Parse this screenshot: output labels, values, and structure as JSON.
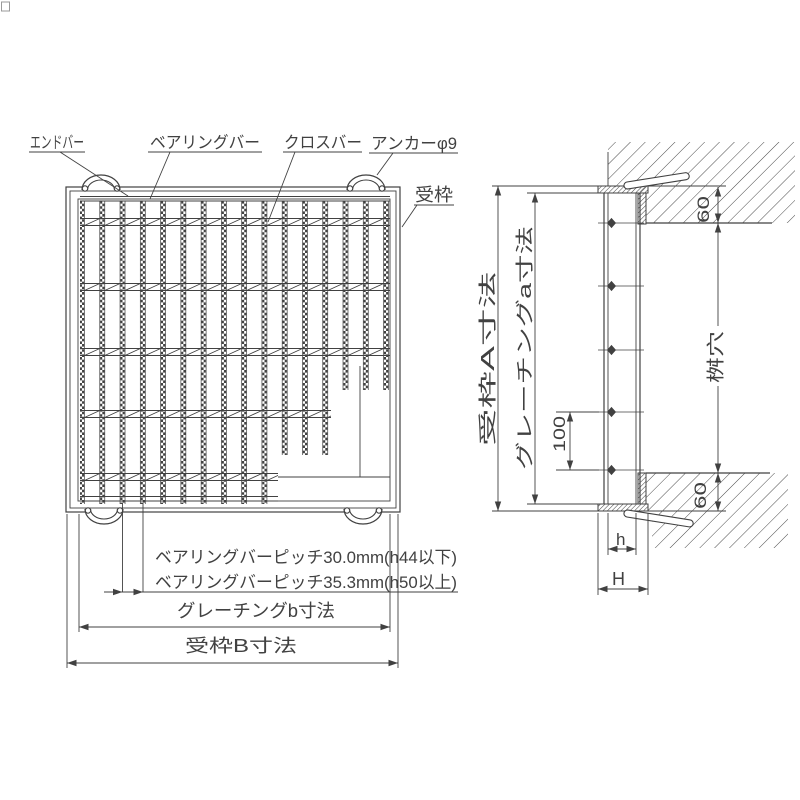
{
  "plan": {
    "labels": {
      "end_bar": "エンドバー",
      "bearing_bar": "ベアリングバー",
      "cross_bar": "クロスバー",
      "anchor": "アンカーφ9",
      "frame": "受枠"
    },
    "notes": {
      "pitch_small": "ベアリングバーピッチ30.0mm(h44以下)",
      "pitch_large": "ベアリングバーピッチ35.3mm(h50以上)"
    },
    "dims": {
      "grating_width": "グレーチングb寸法",
      "frame_width": "受枠B寸法"
    }
  },
  "section": {
    "dims": {
      "frame_span": "受枠A寸法",
      "grating_span": "グレーチングa寸法",
      "pit_opening": "桝穴",
      "anchor_spacing": "100",
      "seat_depth_top": "60",
      "seat_depth_bottom": "60",
      "grating_height": "h",
      "frame_height": "H"
    }
  },
  "colors": {
    "line": "#414141",
    "background": "#ffffff"
  }
}
